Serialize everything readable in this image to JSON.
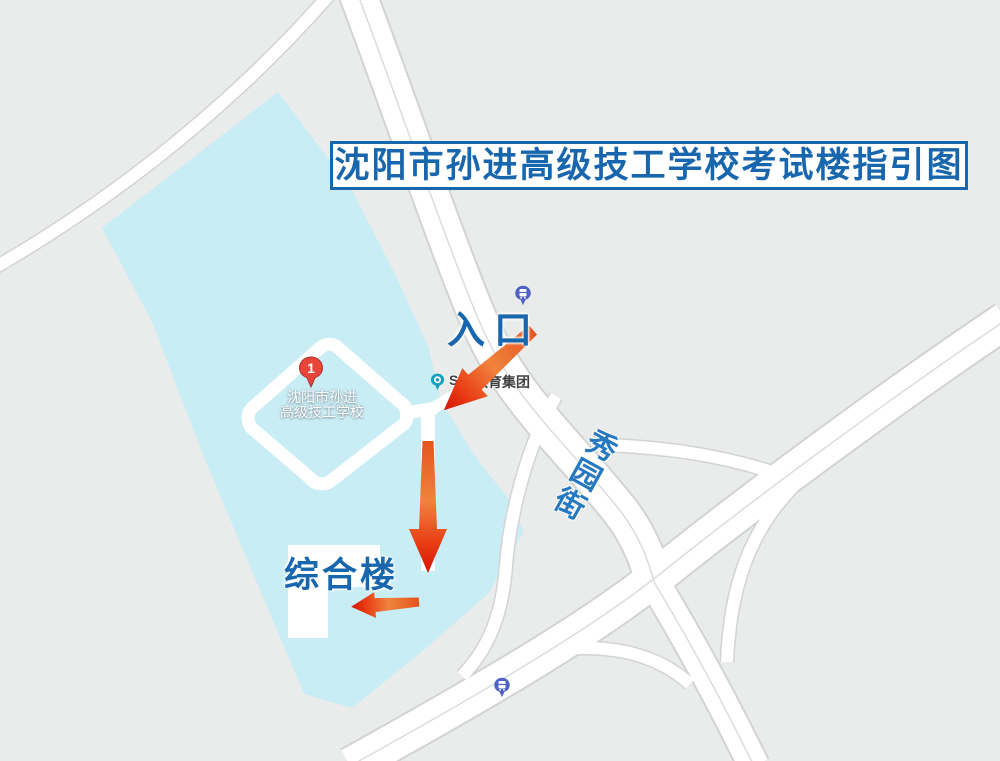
{
  "title": "沈阳市孙进高级技工学校考试楼指引图",
  "labels": {
    "entrance": "入口",
    "main_building": "综合楼"
  },
  "street": {
    "name": "秀园街",
    "chars": [
      "秀",
      "园",
      "街"
    ]
  },
  "school_marker": {
    "number": "1",
    "name_line1": "沈阳市孙进",
    "name_line2": "高级技工学校"
  },
  "poi": {
    "label_prefix": "SU",
    "label_suffix": "教育集团"
  },
  "icons": [
    "location-pin-icon",
    "poi-dot-icon",
    "bus-stop-icon",
    "bus-stop-icon",
    "direction-arrow"
  ],
  "colors": {
    "background": "#eaebeb",
    "campus_fill": "#c9edf5",
    "road_fill": "#ffffff",
    "road_casing": "#d2d3d3",
    "title_blue": "#1866ad",
    "street_blue": "#2679c0",
    "pin_red": "#e8453a",
    "poi_teal": "#10a0ba",
    "bus_indigo": "#5063c4",
    "arrow_gradient_start": "#e4541c",
    "arrow_gradient_mid": "#f0833e",
    "arrow_gradient_end": "#d31505"
  }
}
